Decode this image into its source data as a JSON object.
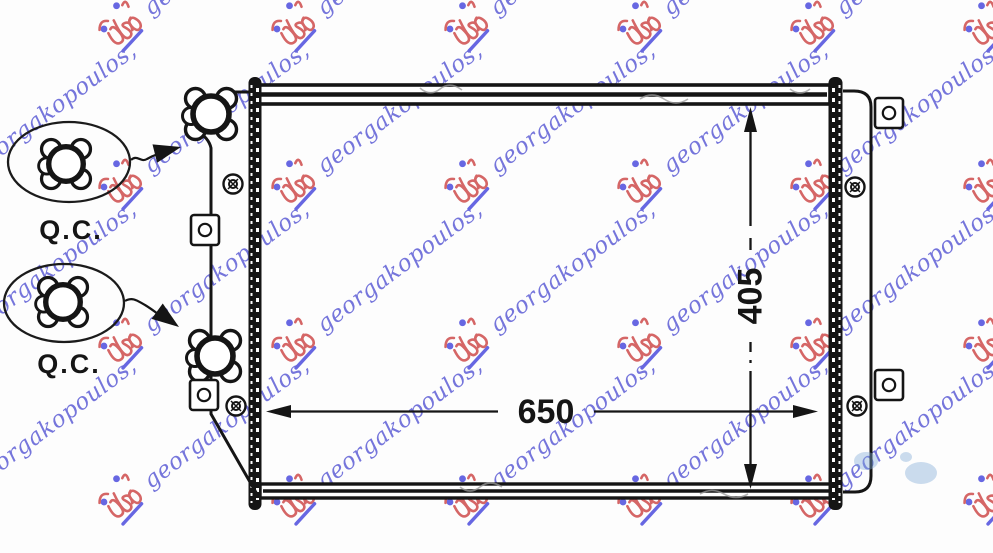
{
  "drawing": {
    "subject": "radiator-technical-drawing",
    "line_color": "#151515",
    "dimensions": {
      "width": {
        "value": "650"
      },
      "height": {
        "value": "405"
      }
    },
    "qc_stamps": [
      {
        "label": "Q.C."
      },
      {
        "label": "Q.C."
      }
    ]
  },
  "watermark": {
    "text": "georgakopoulos,",
    "text_color": "#6a6ad9",
    "logo_color": "#d25a5a",
    "dot_color": "#5b5be0",
    "underline_color": "#5b5be0"
  },
  "artifacts": {
    "smudge_color": "#7fa9d6"
  }
}
